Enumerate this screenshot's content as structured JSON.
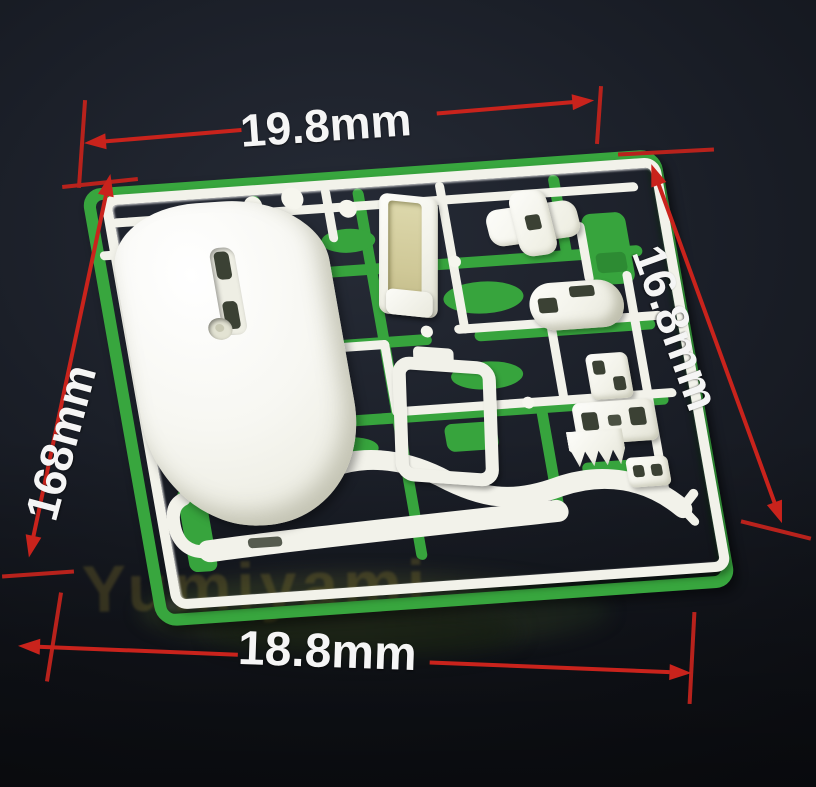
{
  "annotations": {
    "top": "19.8mm",
    "right": "16.8mm",
    "left": "168mm",
    "bottom": "18.8mm"
  },
  "watermark": {
    "text": "Yumiyami"
  },
  "colors": {
    "background": "#14161d",
    "dimension_red": "#c9231c",
    "sprue_green": "#38a63e",
    "part_white": "#f2f2ea",
    "label_white": "#f5f5f5",
    "insert_khaki": "#d6d0a4"
  }
}
